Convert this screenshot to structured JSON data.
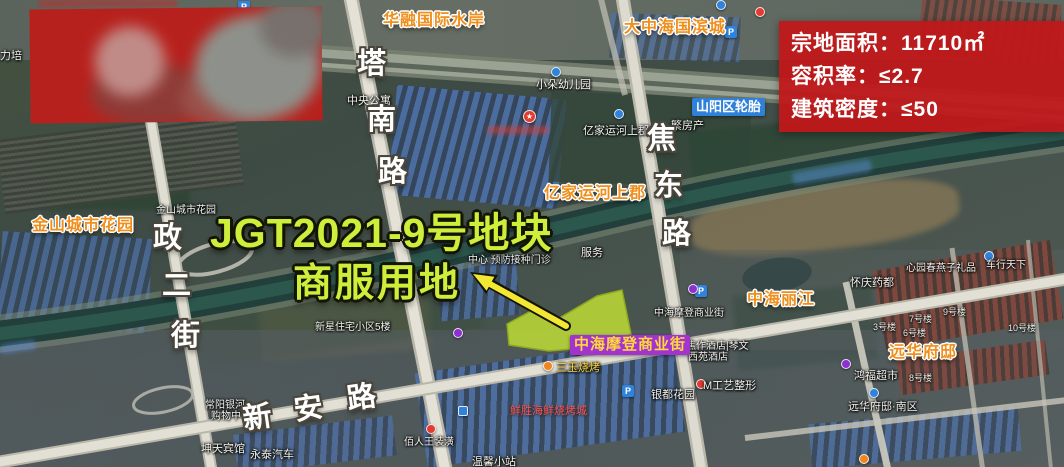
{
  "info_panel": {
    "rows": [
      {
        "label": "宗地面积：",
        "value": "11710㎡"
      },
      {
        "label": "容积率：",
        "value": "≤2.7"
      },
      {
        "label": "建筑密度：",
        "value": "≤50"
      }
    ]
  },
  "title": {
    "line1": "JGT2021-9号地块",
    "line2": "商服用地"
  },
  "roads": {
    "tananlu": [
      "塔",
      "南",
      "路"
    ],
    "zhengerjie": [
      "政",
      "二",
      "街"
    ],
    "jiaodonglu": [
      "焦",
      "东",
      "路"
    ],
    "xinanlu": [
      "新",
      "安",
      "路"
    ]
  },
  "landmarks": [
    "华融国际水岸",
    "大中海国滨城",
    "金山城市花园",
    "亿家运河上郡",
    "中海丽江",
    "远华府邸"
  ],
  "tags": {
    "shopping_street": "中海摩登商业街",
    "tire_factory": "山阳区轮胎"
  },
  "map_labels": [
    "中央公寓",
    "小朵幼儿园",
    "金山城市花园",
    "亿家运河上郡",
    "繁房产",
    "服务",
    "中心 预防接种门诊",
    "新星住宅小区5楼",
    "常阳银河",
    "购物中心",
    "坤天宾馆",
    "永泰汽车",
    "佰人王装潢",
    "银都花园",
    "温馨小站",
    "怀庆药都",
    "心园春燕子礼品",
    "车行天下",
    "中海摩登商业街",
    "焦作酒店|琴文",
    "西苑酒店",
    "M工艺整形",
    "远华府邸·南区",
    "鸿福超市",
    "力培"
  ],
  "building_numbers": [
    "7号楼",
    "3号楼",
    "6号楼",
    "9号楼",
    "10号楼",
    "8号楼"
  ],
  "poi_texts": {
    "bbq": "三玉烧烤",
    "seafood": "鲜胜海鲜烧烤城"
  },
  "glyphs": {
    "parking": "P",
    "star": "★"
  },
  "colors": {
    "panel_red": "#c3181a",
    "title_green": "#cdee3a",
    "parcel_fill": "#c8e832",
    "arrow_yellow": "#f2e733",
    "landmark_orange": "#ef8f1c",
    "tag_purple_bg": "#a233cf",
    "tag_purple_text": "#ffd83a",
    "tag_blue_bg": "#2e80d8"
  }
}
